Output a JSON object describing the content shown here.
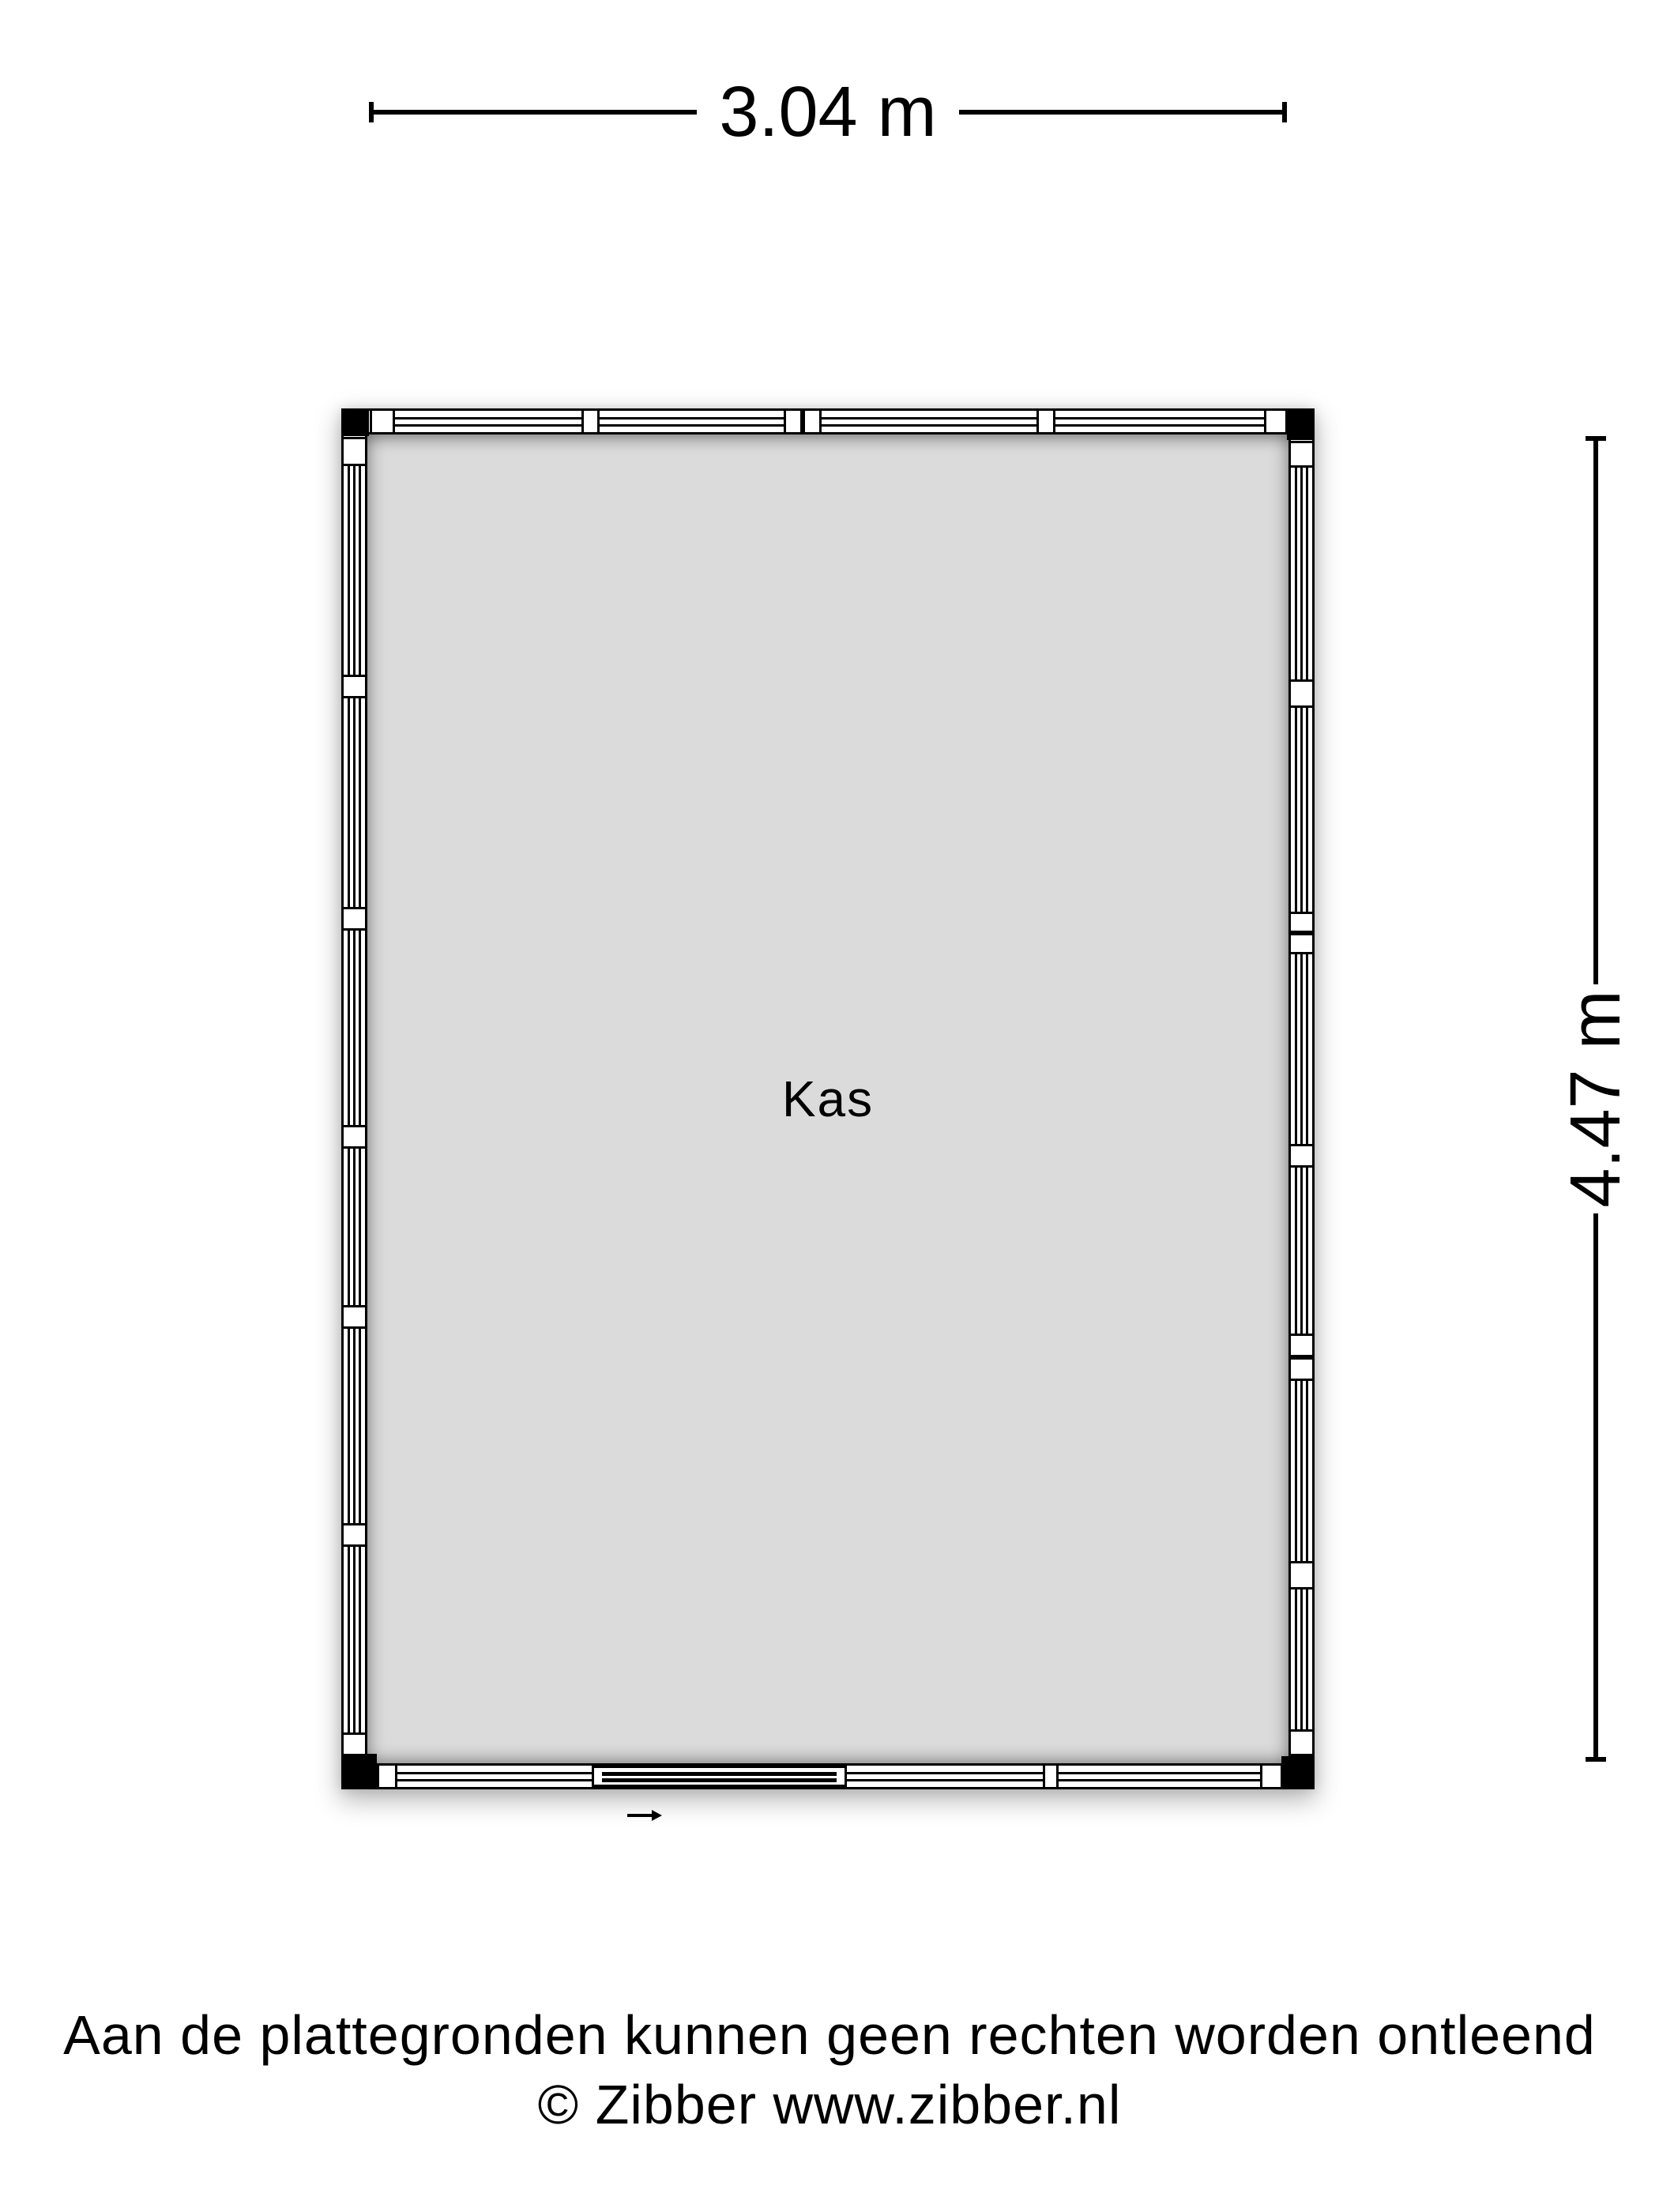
{
  "room": {
    "name": "Kas"
  },
  "dimensions": {
    "width": {
      "label": "3.04 m"
    },
    "height": {
      "label": "4.47 m"
    }
  },
  "footer": {
    "line1": "Aan de plattegronden kunnen geen rechten worden ontleend",
    "line2": "© Zibber www.zibber.nl"
  },
  "colors": {
    "background": "#ffffff",
    "floor_fill": "#dbdbdb",
    "wall_fill": "#ffffff",
    "line": "#000000"
  },
  "door_arrow": {
    "direction": "right"
  },
  "floorplan": {
    "width_m": 3.04,
    "height_m": 4.47,
    "walls": {
      "top": {
        "orientation": "h",
        "segments": [
          [
            "post",
            36,
            68
          ],
          [
            "window",
            68,
            304
          ],
          [
            "post",
            304,
            327
          ],
          [
            "window",
            327,
            560
          ],
          [
            "dpost",
            560,
            608
          ],
          [
            "window",
            608,
            880
          ],
          [
            "post",
            880,
            904
          ],
          [
            "window",
            904,
            1168
          ],
          [
            "post",
            1168,
            1198
          ]
        ]
      },
      "bottom": {
        "orientation": "h",
        "segments": [
          [
            "post",
            45,
            71
          ],
          [
            "window",
            71,
            317
          ],
          [
            "door",
            317,
            640
          ],
          [
            "window",
            640,
            888
          ],
          [
            "post",
            888,
            908
          ],
          [
            "window",
            908,
            1163
          ],
          [
            "post",
            1163,
            1192
          ]
        ]
      },
      "left": {
        "orientation": "v",
        "segments": [
          [
            "post",
            36,
            73
          ],
          [
            "window",
            73,
            337
          ],
          [
            "post",
            337,
            367
          ],
          [
            "window",
            367,
            631
          ],
          [
            "post",
            631,
            661
          ],
          [
            "window",
            661,
            907
          ],
          [
            "post",
            907,
            937
          ],
          [
            "window",
            937,
            1135
          ],
          [
            "post",
            1135,
            1165
          ],
          [
            "window",
            1165,
            1411
          ],
          [
            "post",
            1411,
            1441
          ],
          [
            "window",
            1441,
            1676
          ],
          [
            "post",
            1676,
            1706
          ]
        ]
      },
      "right": {
        "orientation": "v",
        "segments": [
          [
            "post",
            41,
            75
          ],
          [
            "window",
            75,
            343
          ],
          [
            "post",
            343,
            379
          ],
          [
            "window",
            379,
            637
          ],
          [
            "dpost",
            637,
            691
          ],
          [
            "window",
            691,
            931
          ],
          [
            "post",
            931,
            961
          ],
          [
            "window",
            961,
            1171
          ],
          [
            "dpost",
            1171,
            1231
          ],
          [
            "window",
            1231,
            1459
          ],
          [
            "post",
            1459,
            1495
          ],
          [
            "window",
            1495,
            1672
          ],
          [
            "post",
            1672,
            1706
          ]
        ]
      }
    }
  }
}
